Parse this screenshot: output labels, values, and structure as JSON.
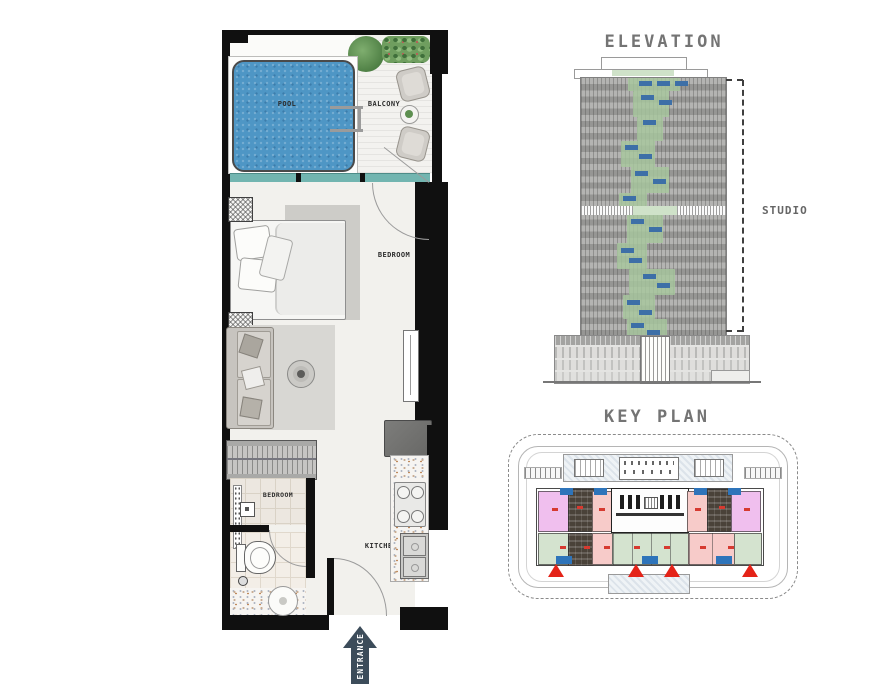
{
  "theme": {
    "bg": "#ffffff",
    "title-gray": "#747474",
    "wall": "#101010",
    "floor": "#f2f1ed",
    "glass": "#72b5b0",
    "pool": "#4e96c5",
    "deck-rug": "#d8d7d3",
    "arrow": "#3c4c5a",
    "facade-a": "#b4b4b2",
    "facade-b": "#969694",
    "strip-green": "#a7c79e",
    "win-blue": "#3d6fa7",
    "kp-plum": "#f0bfee",
    "kp-pink": "#f7cbc9",
    "kp-mint": "#d4e3cf",
    "kp-dark": "#4a4239",
    "kp-blue": "#2e74ba",
    "kp-red": "#e42318"
  },
  "floor_plan": {
    "pool_label": "POOL",
    "balcony_label": "BALCONY",
    "bedroom_label": "BEDROOM",
    "dressing_label": "BEDROOM",
    "kitchen_label": "KITCHEN",
    "entrance_label": "ENTRANCE"
  },
  "elevation": {
    "title": "ELEVATION",
    "unit_label": "STUDIO"
  },
  "key_plan": {
    "title": "KEY PLAN"
  }
}
